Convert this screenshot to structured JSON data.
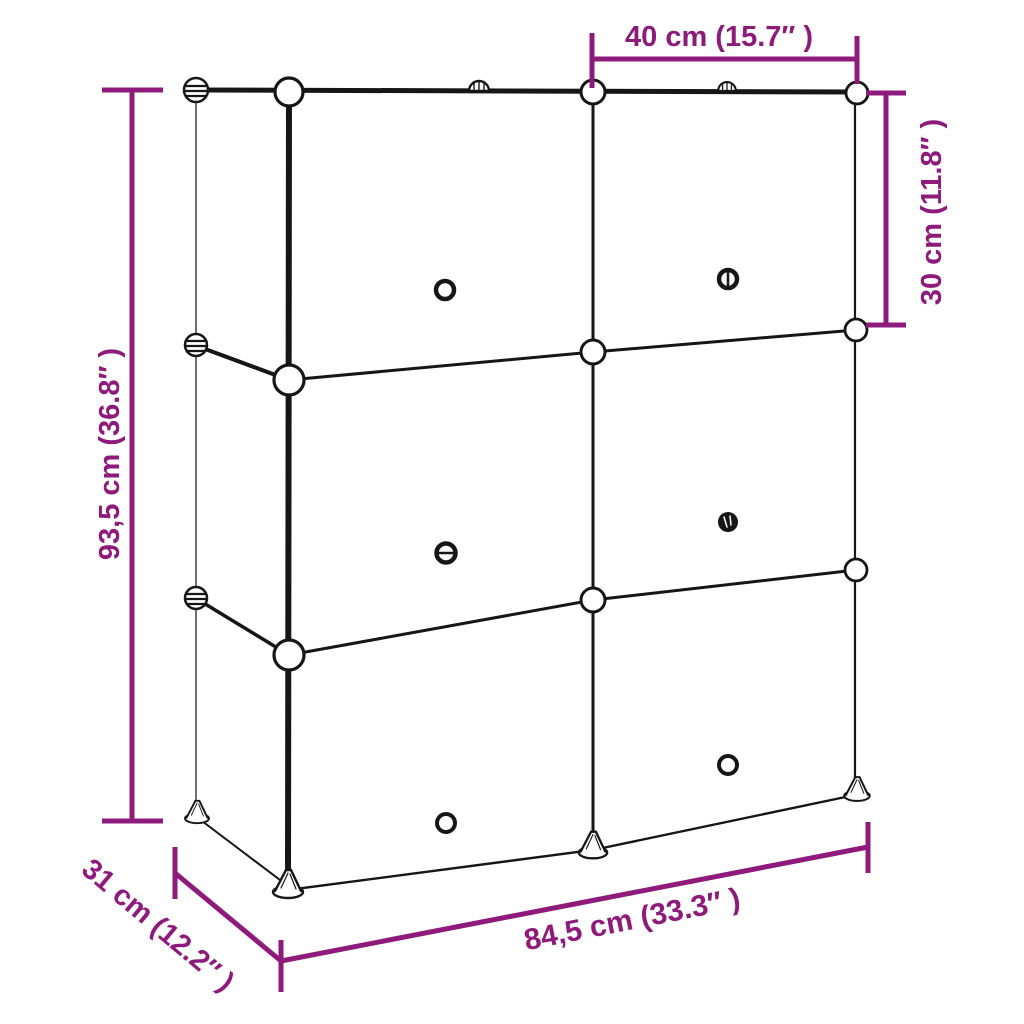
{
  "colors": {
    "dimension_accent": "#8E1B7C",
    "line_art": "#161616",
    "back_edge": "#4A4A4A",
    "background": "#FFFFFF"
  },
  "diagram": {
    "type": "product-dimension-diagram",
    "subject": "cube storage organizer line drawing, 2 columns x 3 rows of compartments",
    "labels": {
      "cube_width": "40 cm (15.7″ )",
      "cube_height": "30 cm (11.8″ )",
      "total_height": "93,5 cm (36.8″ )",
      "depth": "31 cm (12.2″ )",
      "total_width": "84,5 cm (33.3″ )"
    }
  }
}
